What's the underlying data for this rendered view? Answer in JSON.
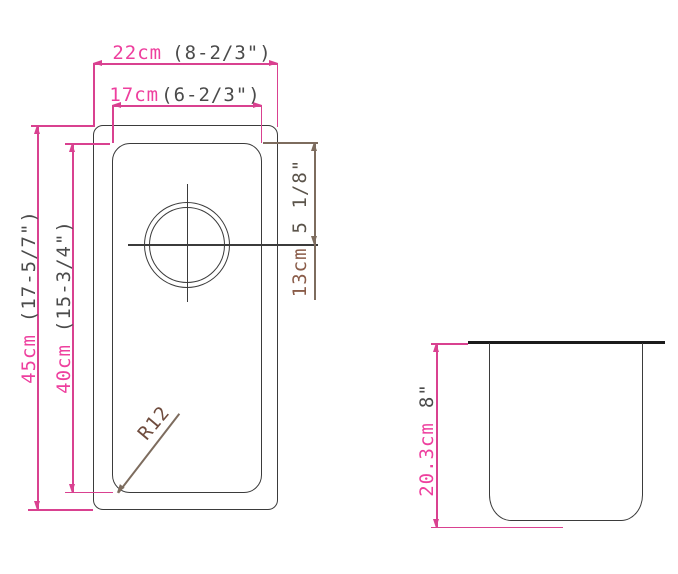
{
  "drawing_title": "undermount-sink-dimension-drawing",
  "top_view": {
    "outer_width": {
      "metric": "22cm",
      "imperial": "(8-2/3\")"
    },
    "inner_width": {
      "metric": "17cm",
      "imperial": "(6-2/3\")"
    },
    "outer_height": {
      "metric": "45cm",
      "imperial": "(17-5/7\")"
    },
    "inner_height": {
      "metric": "40cm",
      "imperial": "(15-3/4\")"
    },
    "drain_offset": {
      "metric": "13cm",
      "imperial": "5 1/8\""
    },
    "corner_radius_label": "R12"
  },
  "side_view": {
    "depth": {
      "metric": "20.3cm",
      "imperial": "8\""
    }
  },
  "colors": {
    "dimension_pink": "#d94190",
    "metric_text_pink": "#ee3f9e",
    "imperial_text_dark": "#4b4b4b",
    "annotation_brown_line": "#7d6c5e",
    "annotation_brown_text": "#8a5c49",
    "outline_dark": "#3b3b3b",
    "counter_black": "#1b1b1b",
    "background": "#ffffff"
  }
}
